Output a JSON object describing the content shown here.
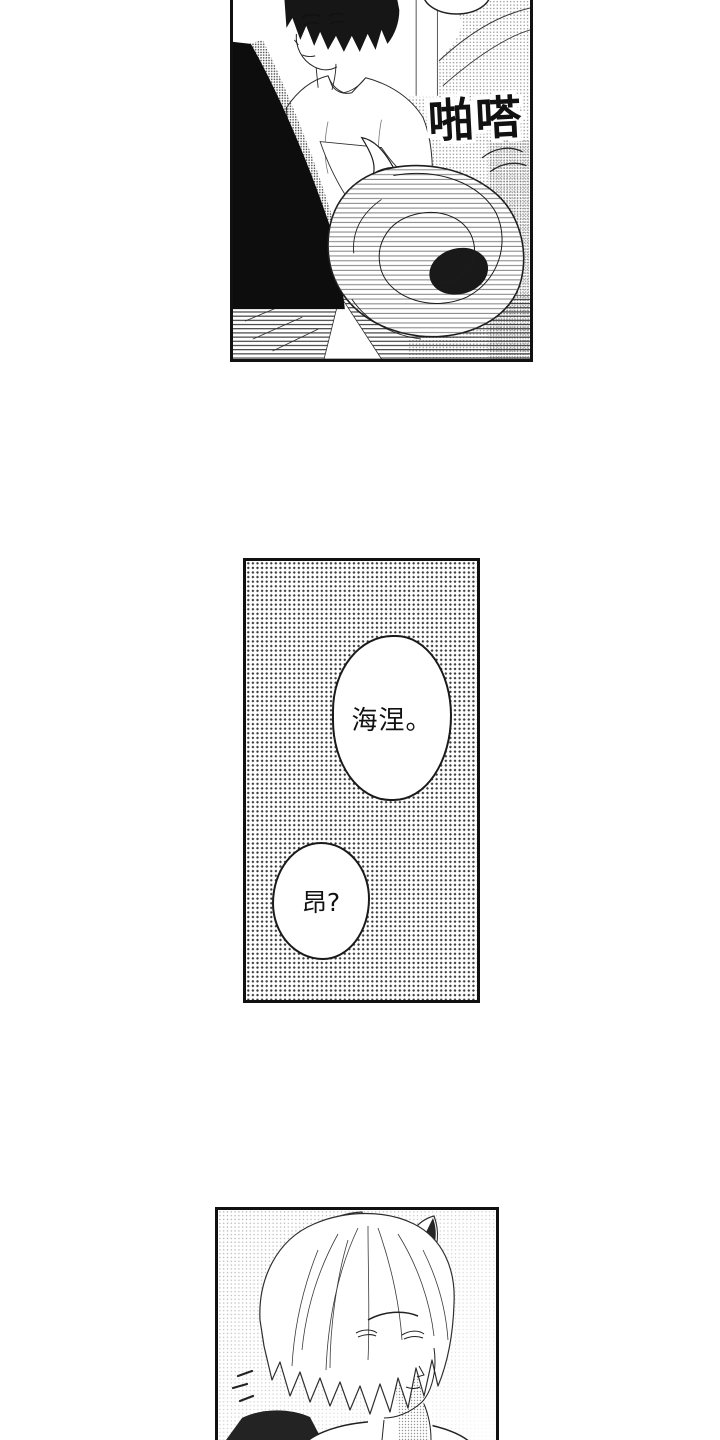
{
  "page": {
    "background_color": "#ffffff"
  },
  "colors": {
    "ink": "#111111",
    "paper": "#ffffff",
    "halftone_dot": "#3d3d3d"
  },
  "panel_top": {
    "sfx": "啪嗒"
  },
  "panel_middle": {
    "bubble_1": "海涅。",
    "bubble_2": "昂?"
  }
}
